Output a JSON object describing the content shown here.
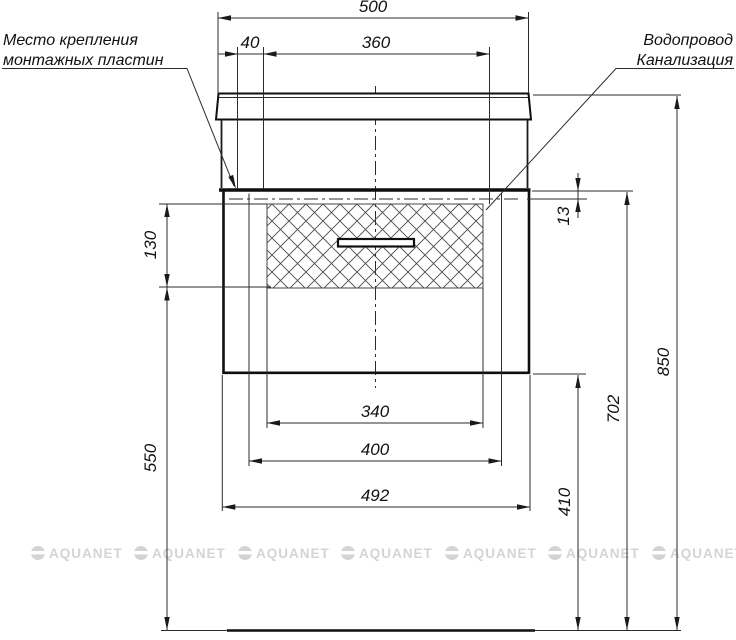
{
  "labels": {
    "mounting": {
      "line1": "Место крепления",
      "line2": "монтажных пластин"
    },
    "plumbing": {
      "line1": "Водопровод",
      "line2": "Канализация"
    }
  },
  "dims": {
    "countertop_width": "500",
    "mounting_plate_width": "40",
    "mounting_plates_span": "360",
    "mounting_offset_from_top": "13",
    "drawer_front_height": "130",
    "bottom_zone_height": "550",
    "inner_width": "340",
    "plate_centers_distance": "400",
    "cabinet_width": "492",
    "cabinet_top_from_floor": "702",
    "total_height": "850",
    "floor_clearance": "410"
  },
  "watermark": {
    "text": "AQUANET"
  }
}
